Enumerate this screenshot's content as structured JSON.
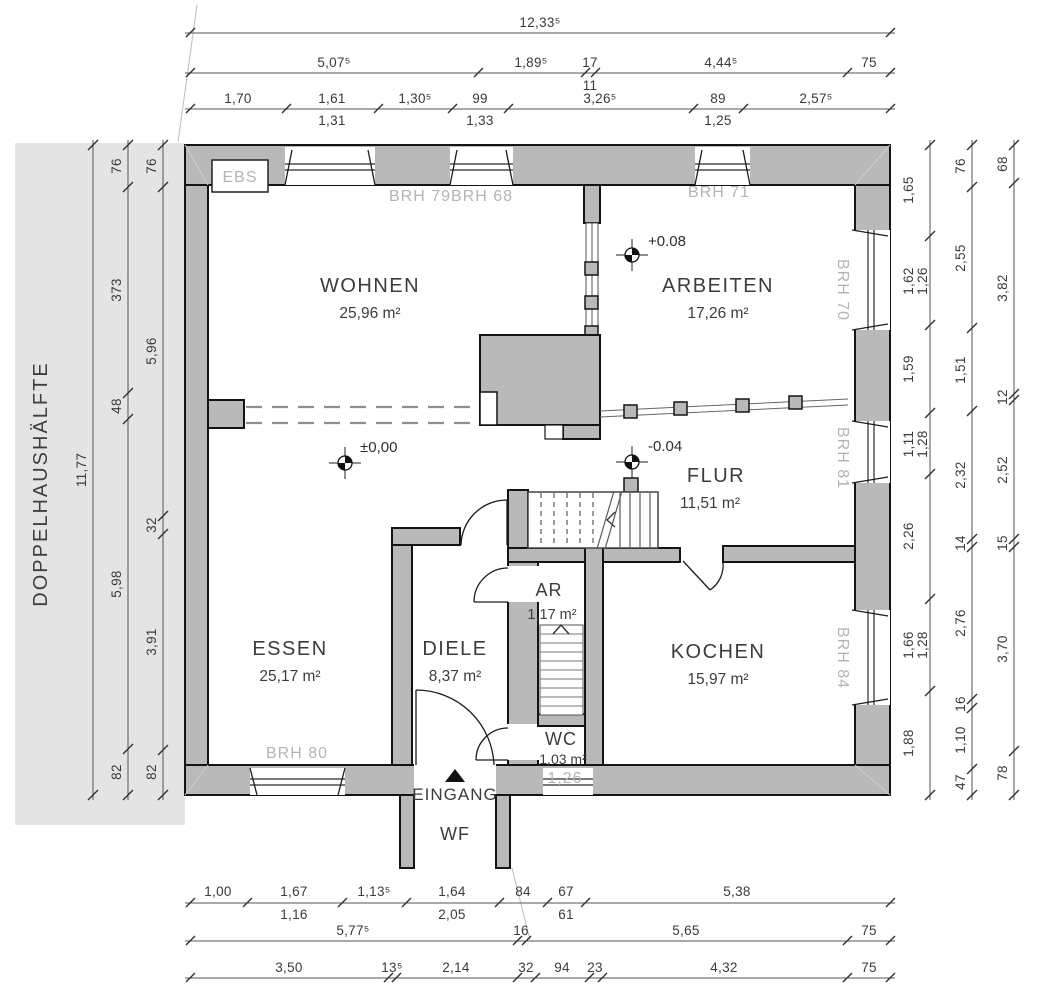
{
  "drawing": {
    "site_label": "DOPPELHAUSHÄLFTE",
    "rooms": {
      "wohnen": {
        "name": "WOHNEN",
        "area": "25,96 m²"
      },
      "arbeiten": {
        "name": "ARBEITEN",
        "area": "17,26 m²"
      },
      "essen": {
        "name": "ESSEN",
        "area": "25,17 m²"
      },
      "diele": {
        "name": "DIELE",
        "area": "8,37 m²"
      },
      "flur": {
        "name": "FLUR",
        "area": "11,51 m²"
      },
      "kochen": {
        "name": "KOCHEN",
        "area": "15,97 m²"
      },
      "ar": {
        "name": "AR",
        "area": "1,17 m²"
      },
      "wc": {
        "name": "WC",
        "area": "1,03 m²",
        "sill": "1,26"
      }
    },
    "annotations": {
      "ebs": "EBS",
      "eingang": "EINGANG",
      "wf": "WF"
    },
    "levels": {
      "essen": "±0,00",
      "arbeiten": "+0.08",
      "flur": "-0.04"
    },
    "brh": {
      "w79": "BRH 79",
      "w68": "BRH 68",
      "w71": "BRH 71",
      "w70": "BRH 70",
      "w81": "BRH 81",
      "w84": "BRH 84",
      "w80": "BRH 80"
    }
  },
  "dims": {
    "top1": [
      "12,33⁵"
    ],
    "top2": [
      "5,07⁵",
      "1,89⁵",
      "17",
      "11",
      "4,44⁵",
      "75"
    ],
    "top3": [
      "1,70",
      "1,61",
      "1,30⁵",
      "99",
      "3,26⁵",
      "89",
      "2,57⁵"
    ],
    "top3_sub": [
      "1,31",
      "1,33",
      "1,25"
    ],
    "bot1": [
      "1,00",
      "1,67",
      "1,13⁵",
      "1,64",
      "84",
      "67",
      "5,38"
    ],
    "bot1_sub": [
      "1,16",
      "2,05",
      "61"
    ],
    "bot2": [
      "5,77⁵",
      "16",
      "5,65",
      "75"
    ],
    "bot3": [
      "3,50",
      "13⁵",
      "2,14",
      "32",
      "94",
      "23",
      "4,32",
      "75"
    ],
    "left_outer": [
      "11,77"
    ],
    "left_mid": [
      "76",
      "373",
      "48",
      "5,98",
      "82"
    ],
    "left_inner": [
      "76",
      "5,96",
      "32",
      "3,91",
      "82"
    ],
    "right_inner": [
      "1,65",
      "1,62",
      "1,59",
      "1,11",
      "2,26",
      "1,66",
      "1,88"
    ],
    "right_inner_sub": [
      "1,26",
      "1,28",
      "1,28"
    ],
    "right_mid": [
      "76",
      "2,55",
      "1,51",
      "2,32",
      "14",
      "2,76",
      "16",
      "1,10",
      "47"
    ],
    "right_outer": [
      "68",
      "3,82",
      "12",
      "2,52",
      "15",
      "3,70",
      "78"
    ]
  },
  "colors": {
    "wall_fill": "#b9b9b9",
    "site_fill": "#e4e4e4",
    "brh_text": "#b4b4b4",
    "dim_text": "#3a3a3a"
  }
}
